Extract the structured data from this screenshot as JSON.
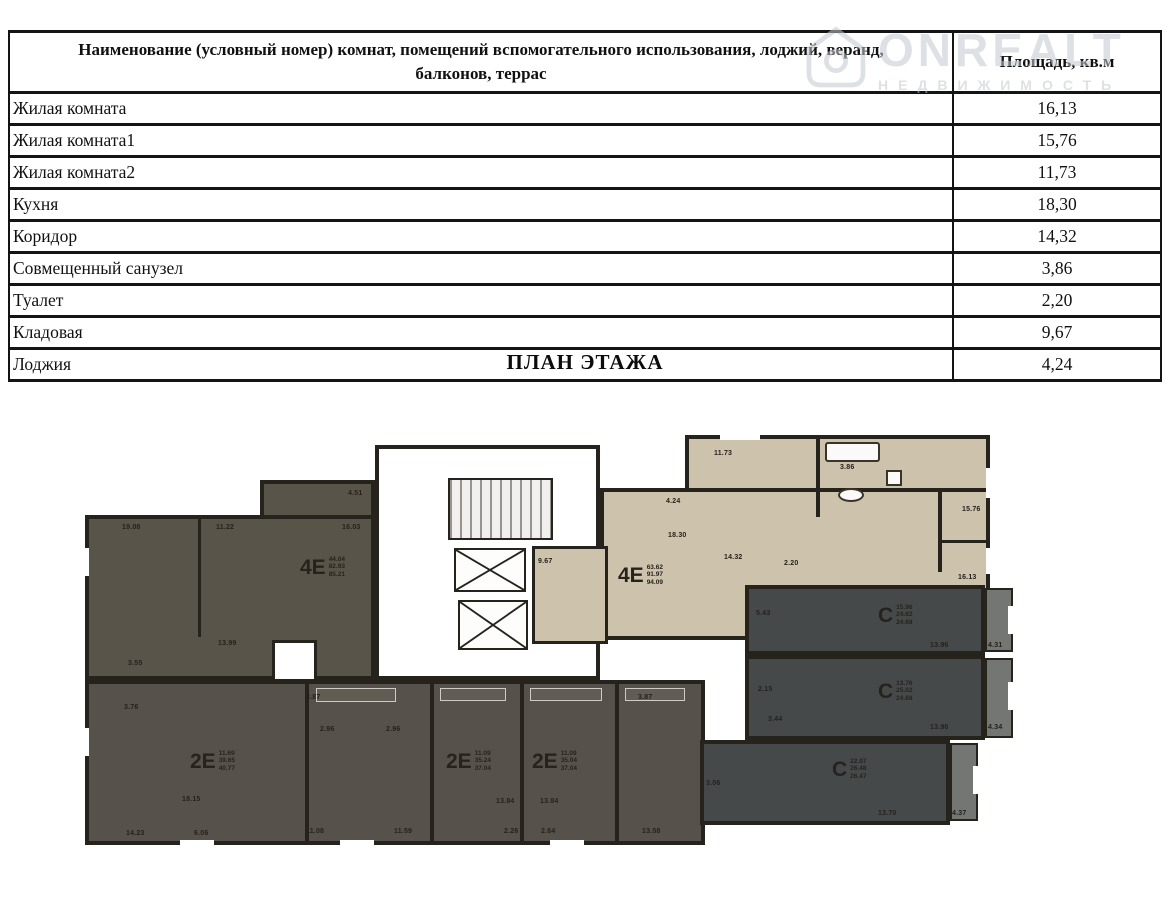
{
  "table": {
    "header": {
      "name_col": "Наименование (условный номер) комнат, помещений вспомогательного использования, лоджий, веранд, балконов, террас",
      "area_col": "Площадь, кв.м"
    },
    "rows": [
      {
        "name": "Жилая комната",
        "area": "16,13"
      },
      {
        "name": "Жилая комната1",
        "area": "15,76"
      },
      {
        "name": "Жилая комната2",
        "area": "11,73"
      },
      {
        "name": "Кухня",
        "area": "18,30"
      },
      {
        "name": "Коридор",
        "area": "14,32"
      },
      {
        "name": "Совмещенный санузел",
        "area": "3,86"
      },
      {
        "name": "Туалет",
        "area": "2,20"
      },
      {
        "name": "Кладовая",
        "area": "9,67"
      },
      {
        "name": "Лоджия",
        "area": "4,24"
      }
    ]
  },
  "title": "ПЛАН ЭТАЖА",
  "watermark": {
    "line1": "ONREALT",
    "line2": "НЕДВИЖИМОСТЬ"
  },
  "colors": {
    "wall": "#26221c",
    "dark_apartment": "#59544a",
    "bottom_row": "#56524b",
    "beige_apartment": "#cdc2ab",
    "studio": "#46494a",
    "balcony": "#737672",
    "watermark": "#c3cad1"
  },
  "plan": {
    "apartments": [
      {
        "tag": "4Е",
        "areas": [
          "44.04",
          "82.93",
          "85.21"
        ],
        "x": 220,
        "y": 128
      },
      {
        "tag": "4Е",
        "areas": [
          "63.62",
          "91.97",
          "94.09"
        ],
        "x": 538,
        "y": 136
      },
      {
        "tag": "2Е",
        "areas": [
          "11.69",
          "39.65",
          "40.77"
        ],
        "x": 110,
        "y": 322
      },
      {
        "tag": "2Е",
        "areas": [
          "11.09",
          "35.24",
          "37.04"
        ],
        "x": 366,
        "y": 322
      },
      {
        "tag": "2Е",
        "areas": [
          "11.09",
          "35.04",
          "37.04"
        ],
        "x": 452,
        "y": 322
      },
      {
        "tag": "С",
        "areas": [
          "15.96",
          "24.62",
          "24.68"
        ],
        "x": 798,
        "y": 176
      },
      {
        "tag": "С",
        "areas": [
          "13.76",
          "25.02",
          "24.68"
        ],
        "x": 798,
        "y": 252
      },
      {
        "tag": "С",
        "areas": [
          "22.07",
          "26.48",
          "26.47"
        ],
        "x": 752,
        "y": 330
      }
    ],
    "room_labels": [
      {
        "t": "19.08",
        "x": 42,
        "y": 96
      },
      {
        "t": "11.22",
        "x": 136,
        "y": 96
      },
      {
        "t": "16.03",
        "x": 262,
        "y": 96
      },
      {
        "t": "4.51",
        "x": 268,
        "y": 62
      },
      {
        "t": "13.99",
        "x": 138,
        "y": 212
      },
      {
        "t": "3.55",
        "x": 48,
        "y": 232
      },
      {
        "t": "3.76",
        "x": 44,
        "y": 276
      },
      {
        "t": "18.15",
        "x": 102,
        "y": 368
      },
      {
        "t": "14.23",
        "x": 46,
        "y": 402
      },
      {
        "t": "6.06",
        "x": 114,
        "y": 402
      },
      {
        "t": "3.87",
        "x": 226,
        "y": 266
      },
      {
        "t": "2.96",
        "x": 240,
        "y": 298
      },
      {
        "t": "2.96",
        "x": 306,
        "y": 298
      },
      {
        "t": "11.08",
        "x": 226,
        "y": 400
      },
      {
        "t": "11.59",
        "x": 314,
        "y": 400
      },
      {
        "t": "13.84",
        "x": 416,
        "y": 370
      },
      {
        "t": "13.84",
        "x": 460,
        "y": 370
      },
      {
        "t": "2.26",
        "x": 424,
        "y": 400
      },
      {
        "t": "2.64",
        "x": 461,
        "y": 400
      },
      {
        "t": "3.87",
        "x": 558,
        "y": 266
      },
      {
        "t": "13.58",
        "x": 562,
        "y": 400
      },
      {
        "t": "11.73",
        "x": 634,
        "y": 22
      },
      {
        "t": "3.86",
        "x": 760,
        "y": 36
      },
      {
        "t": "4.24",
        "x": 586,
        "y": 70
      },
      {
        "t": "18.30",
        "x": 588,
        "y": 104
      },
      {
        "t": "14.32",
        "x": 644,
        "y": 126
      },
      {
        "t": "2.20",
        "x": 704,
        "y": 132
      },
      {
        "t": "9.67",
        "x": 458,
        "y": 130
      },
      {
        "t": "15.76",
        "x": 882,
        "y": 78
      },
      {
        "t": "16.13",
        "x": 878,
        "y": 146
      },
      {
        "t": "5.43",
        "x": 676,
        "y": 182
      },
      {
        "t": "13.96",
        "x": 850,
        "y": 214
      },
      {
        "t": "4.31",
        "x": 908,
        "y": 214
      },
      {
        "t": "2.15",
        "x": 678,
        "y": 258
      },
      {
        "t": "3.44",
        "x": 688,
        "y": 288
      },
      {
        "t": "13.96",
        "x": 850,
        "y": 296
      },
      {
        "t": "4.34",
        "x": 908,
        "y": 296
      },
      {
        "t": "3.06",
        "x": 626,
        "y": 352
      },
      {
        "t": "13.70",
        "x": 798,
        "y": 382
      },
      {
        "t": "4.37",
        "x": 872,
        "y": 382
      }
    ]
  }
}
